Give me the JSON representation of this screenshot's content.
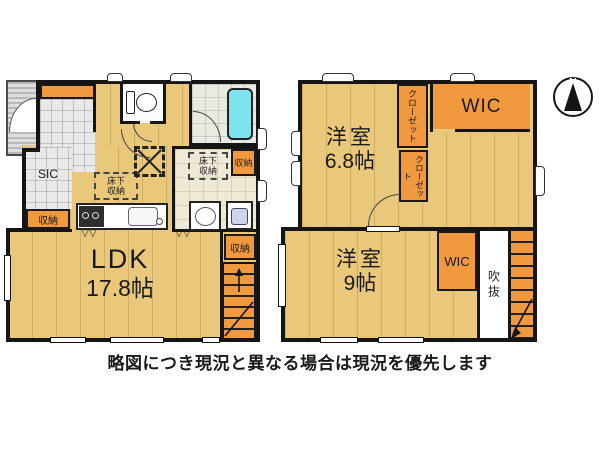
{
  "caption": "略図につき現況と異なる場合は現況を優先します",
  "compass": {
    "north_label": "N"
  },
  "floor1": {
    "ldk": {
      "name": "LDK",
      "size": "17.8帖"
    },
    "sic_label": "SIC",
    "storage_label": "収納",
    "underfloor_storage_label": "床下\n収納",
    "fold_door_marks": "▽▽"
  },
  "floor2": {
    "room_a": {
      "name": "洋室",
      "size": "6.8帖"
    },
    "room_b": {
      "name": "洋室",
      "size": "9帖"
    },
    "wic_label": "WIC",
    "closet_label": "クローゼット",
    "void_label": "吹抜"
  },
  "colors": {
    "wood_floor": "#e9c87c",
    "storage_orange": "#f0993f",
    "bathtub_cyan": "#7fe3ef",
    "wall_black": "#151515",
    "porch_gray": "#cfcfcf"
  }
}
